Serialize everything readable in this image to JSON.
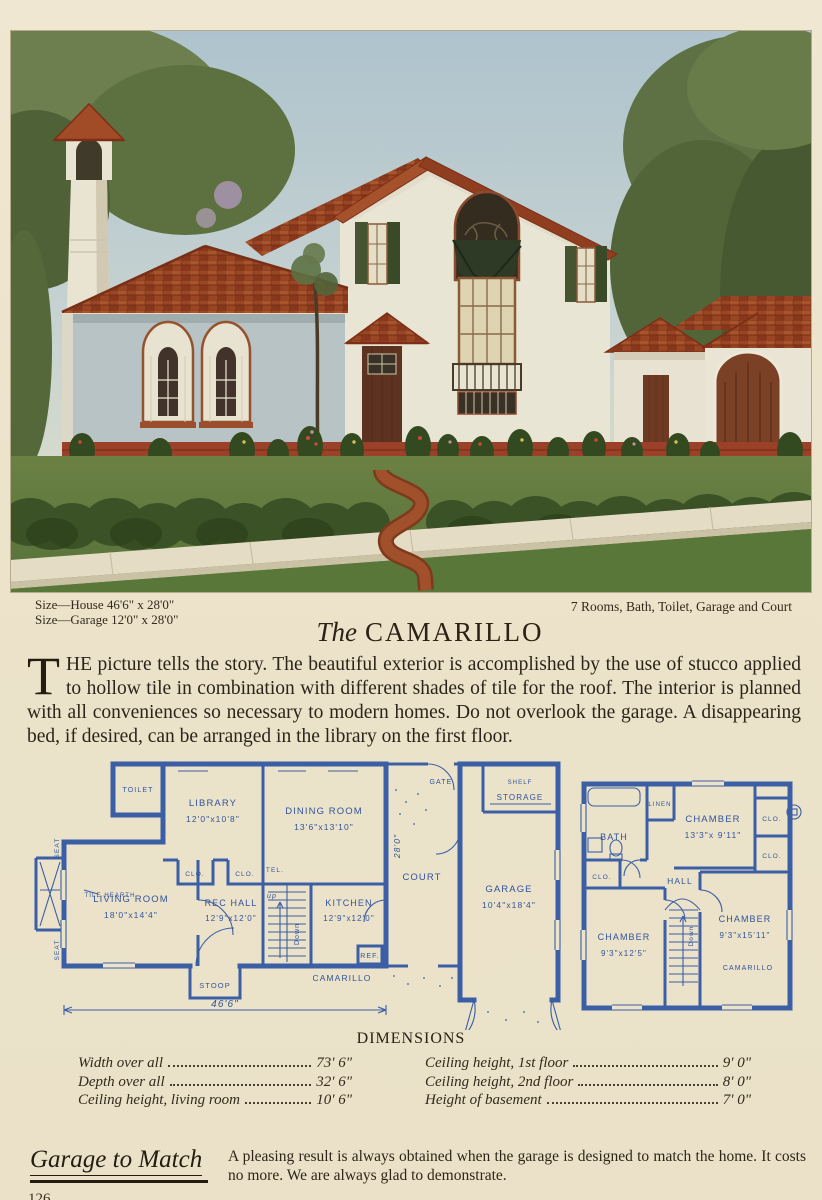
{
  "page": {
    "number": "126"
  },
  "specs": {
    "size_house": "Size—House 46'6\" x 28'0\"",
    "size_garage": "Size—Garage 12'0\" x 28'0\"",
    "features": "7 Rooms, Bath, Toilet, Garage and Court"
  },
  "title": {
    "the": "The",
    "name": "CAMARILLO"
  },
  "intro": {
    "dropcap": "T",
    "rest": "HE picture tells the story.  The beautiful exterior is accomplished by the use of stucco applied to hollow tile in combination with different shades of tile for the roof.  The interior is planned with all conveniences so necessary to modern homes.  Do not overlook the garage.  A disappearing bed, if desired, can be arranged in the library on the first floor."
  },
  "plans": {
    "first": {
      "toilet": "TOILET",
      "library": "LIBRARY",
      "library_size": "12'0\"x10'8\"",
      "dining": "DINING ROOM",
      "dining_size": "13'6\"x13'10\"",
      "living": "LIVING ROOM",
      "living_size": "18'0\"x14'4\"",
      "tile_hearth": "TILE HEARTH",
      "seat_a": "SEAT",
      "seat_b": "SEAT",
      "rec_hall": "REC HALL",
      "rec_hall_size": "12'9\"x12'0\"",
      "kitchen": "KITCHEN",
      "kitchen_size": "12'9\"x12'0\"",
      "clo_a": "CLO.",
      "clo_b": "CLO.",
      "tel": "TEL.",
      "ref": "REF.",
      "up": "up",
      "down": "Down",
      "gate": "GATE",
      "shelf": "SHELF",
      "storage": "STORAGE",
      "court": "COURT",
      "court_depth": "28'0\"",
      "garage": "GARAGE",
      "garage_size": "10'4\"x18'4\"",
      "stoop": "STOOP",
      "name": "CAMARILLO",
      "width": "46'6\""
    },
    "second": {
      "bath": "BATH",
      "linen": "LINEN",
      "chamber_a": "CHAMBER",
      "chamber_a_size": "13'3\"x 9'11\"",
      "clo_a": "CLO.",
      "clo_b": "CLO.",
      "clo_c": "CLO.",
      "hall": "HALL",
      "chamber_b": "CHAMBER",
      "chamber_b_size": "9'3\"x12'5\"",
      "chamber_c": "CHAMBER",
      "chamber_c_size": "9'3\"x15'11\"",
      "down": "Down",
      "name": "CAMARILLO"
    }
  },
  "dimensions": {
    "heading": "DIMENSIONS",
    "left": [
      {
        "label": "Width over all",
        "value": "73' 6\""
      },
      {
        "label": "Depth over all",
        "value": "32' 6\""
      },
      {
        "label": "Ceiling height, living room",
        "value": "10' 6\""
      }
    ],
    "right": [
      {
        "label": "Ceiling height, 1st floor",
        "value": "9' 0\""
      },
      {
        "label": "Ceiling height, 2nd floor",
        "value": "8' 0\""
      },
      {
        "label": "Height of basement",
        "value": "7' 0\""
      }
    ]
  },
  "footer": {
    "heading": "Garage to Match",
    "text": "A pleasing result is always obtained when the garage is designed to match the home.  It costs no more.  We are always glad to demonstrate."
  },
  "colors": {
    "paper": "#ece3cb",
    "ink": "#2b2418",
    "blueprint": "#3a5fa4",
    "roof": "#9a4524",
    "lawn": "#5f7b3c"
  }
}
